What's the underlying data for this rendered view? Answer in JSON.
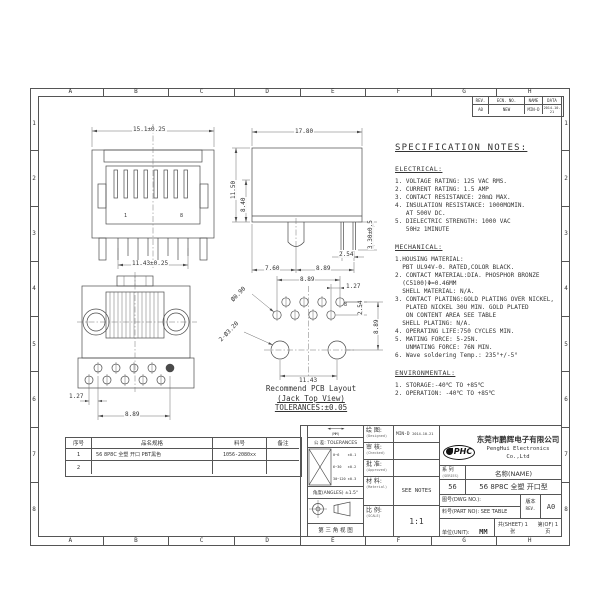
{
  "sheet": {
    "zones_top": [
      "A",
      "B",
      "C",
      "D",
      "E",
      "F",
      "G",
      "H"
    ],
    "zones_bottom": [
      "A",
      "B",
      "C",
      "D",
      "E",
      "F",
      "G",
      "H"
    ],
    "zones_left": [
      "1",
      "2",
      "3",
      "4",
      "5",
      "6",
      "7",
      "8"
    ],
    "zones_right": [
      "1",
      "2",
      "3",
      "4",
      "5",
      "6",
      "7",
      "8"
    ]
  },
  "revision_table": {
    "headers": [
      "REV.",
      "ECN. NO.",
      "NAME",
      "DATA"
    ],
    "row": [
      "A0",
      "NEW",
      "MIN-D",
      "2014-10-21"
    ]
  },
  "views": {
    "front": {
      "dim_width_top": "15.1±0.25",
      "dim_width_pins": "11.43±0.25",
      "pin_first": "1",
      "pin_last": "8"
    },
    "side": {
      "dim_width": "17.80",
      "dim_height": "11.50",
      "dim_height_inner": "8.40",
      "dim_pin": "3.30±0.5",
      "dim_b1": "7.60",
      "dim_b2": "8.89",
      "dim_b3": "2.54"
    },
    "bottom": {
      "dim_pitch": "1.27",
      "dim_span": "8.89"
    },
    "pcb": {
      "dim_span": "8.89",
      "dim_offset": "1.27",
      "dim_row": "2.54",
      "dim_depth": "8.89",
      "dim_holes": "11.43",
      "dia_pin": "Ø0.90",
      "dia_post": "2-Ø3.20",
      "pin_last": "8",
      "caption1": "Recommend PCB Layout",
      "caption2": "(Jack Top View)",
      "caption3": "TOLERANCES:±0.05"
    }
  },
  "spec": {
    "title": "SPECIFICATION NOTES:",
    "electrical_title": "ELECTRICAL:",
    "electrical": [
      "1. VOLTAGE RATING: 125 VAC RMS.",
      "2. CURRENT RATING: 1.5 AMP",
      "3. CONTACT RESISTANCE: 20mΩ MAX.",
      "4. INSULATION RESISTANCE: 1000MΩMIN.",
      "   AT 500V DC.",
      "5. DIELECTRIC STRENGTH: 1000 VAC",
      "   50Hz 1MINUTE"
    ],
    "mechanical_title": "MECHANICAL:",
    "mechanical": [
      "1.HOUSING MATERIAL:",
      "  PBT UL94V-0. RATED,COLOR BLACK.",
      "2. CONTACT MATERIAL:DIA. PHOSPHOR BRONZE",
      "  (C5100)Φ=0.46MM",
      "  SHELL MATERIAL: N/A.",
      "3. CONTACT PLATING:GOLD PLATING OVER NICKEL,",
      "   PLATED NICKEL 30U MIN. GOLD PLATED",
      "   ON CONTENT AREA SEE TABLE",
      "  SHELL PLATING: N/A.",
      "4. OPERATING LIFE:750 CYCLES MIN.",
      "5. MATING FORCE: 5-25N.",
      "   UNMATING FORCE: 76N MIN.",
      "6. Wave soldering Temp.: 235°+/-5°"
    ],
    "environmental_title": "ENVIRONMENTAL:",
    "environmental": [
      "1. STORAGE:-40℃ TO +85℃",
      "2. OPERATION: -40℃ TO +85℃"
    ]
  },
  "parts_table": {
    "headers": [
      "序号",
      "品名规格",
      "料号",
      "备注"
    ],
    "rows": [
      [
        "1",
        "56 8P8C 全塑 开口 PBT黑色",
        "1056-2080xx",
        ""
      ],
      [
        "2",
        "",
        "",
        ""
      ]
    ]
  },
  "title_block": {
    "mm_label": "(MM)",
    "tolerances_label": "公 差: TOLERANCES",
    "tol_rows": [
      "0~6    ±0.1",
      "6~30   ±0.2",
      "30~120 ±0.3"
    ],
    "angles_label": "角度(ANGLES) ±1.5°",
    "third_angle_label": "第 三 角 视 图",
    "designed_label": "绘 图:",
    "designed_sub": "(Designed)",
    "designed_value": "MIN-D",
    "designed_date": "2014-10-21",
    "checked_label": "审 核:",
    "checked_sub": "(Checked)",
    "approved_label": "批 准:",
    "approved_sub": "(Approved)",
    "material_label": "材 料:",
    "material_sub": "(Material)",
    "material_value": "SEE NOTES",
    "scale_label": "比 例:",
    "scale_sub": "(SCALE)",
    "scale_value": "1:1",
    "logo_text": "PHC",
    "company_cn": "东莞市鹏辉电子有限公司",
    "company_en": "PengHui Electronics Co.,Ltd",
    "series_label": "系 列",
    "series_sub": "(SERIES)",
    "name_label": "名称(NAME)",
    "series_value": "56",
    "name_value": "56 8P8C 全塑 开口型",
    "dwg_label": "图号(DWG NO.):",
    "part_label": "料号(PART NO): SEE TABLE",
    "rev_label": "版本",
    "rev_sub": "REV.",
    "rev_value": "A0",
    "unit_label": "单位(UNIT):",
    "unit_value": "MM",
    "sheet_text": "共(SHEET) 1 张",
    "of_text": "第(OF) 1 页"
  }
}
